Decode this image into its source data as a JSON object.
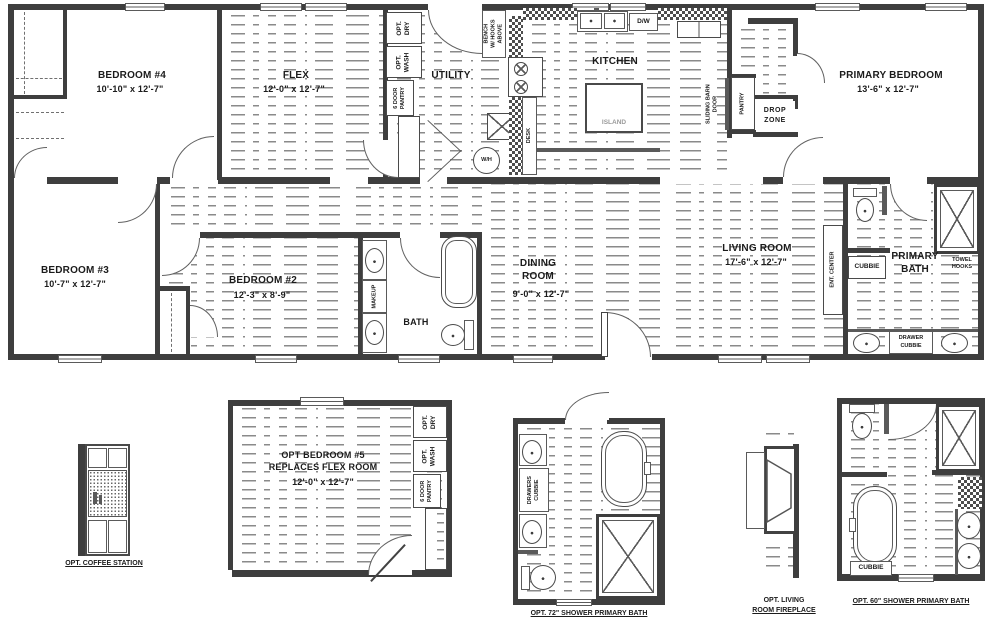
{
  "main": {
    "bedroom4": {
      "name": "BEDROOM #4",
      "dims": "10'-10\" x  12'-7\""
    },
    "flex": {
      "name": "FLEX",
      "dims": "12'-0\" x  12'-7\""
    },
    "utility": {
      "name": "UTILITY"
    },
    "kitchen": {
      "name": "KITCHEN"
    },
    "primary_bedroom": {
      "name": "PRIMARY BEDROOM",
      "dims": "13'-6\" x  12'-7\""
    },
    "bedroom3": {
      "name": "BEDROOM #3",
      "dims": "10'-7\" x  12'-7\""
    },
    "bedroom2": {
      "name": "BEDROOM #2",
      "dims": "12'-3\" x  8'-9\""
    },
    "dining": {
      "l1": "DINING",
      "l2": "ROOM",
      "dims": "9'-0\" x  12'-7\""
    },
    "living": {
      "name": "LIVING ROOM",
      "dims": "17'-6\" x  12'-7\""
    },
    "bath": {
      "name": "BATH"
    },
    "primary_bath": {
      "l1": "PRIMARY",
      "l2": "BATH"
    },
    "labels": {
      "opt_dry_l1": "OPT.",
      "opt_dry_l2": "DRY",
      "opt_wash_l1": "OPT.",
      "opt_wash_l2": "WASH",
      "pantry6_l1": "6 DOOR",
      "pantry6_l2": "PANTRY",
      "bench_l1": "BENCH",
      "bench_l2": "W/ HOOKS",
      "bench_l3": "ABOVE",
      "dw": "D/W",
      "island": "ISLAND",
      "desk": "DESK",
      "wh": "W/H",
      "sliding_l1": "SLIDING BARN",
      "sliding_l2": "DOOR",
      "pantry": "PANTRY",
      "drop_l1": "DROP",
      "drop_l2": "ZONE",
      "makeup": "MAKEUP",
      "ent_center": "ENT. CENTER",
      "cubbie": "CUBBIE",
      "towel_l1": "TOWEL",
      "towel_l2": "HOOKS",
      "drawer_l1": "DRAWER",
      "drawer_l2": "CUBBIE"
    }
  },
  "details": {
    "coffee": {
      "label": "OPT. COFFEE STATION"
    },
    "bedroom5": {
      "l1": "OPT BEDROOM #5",
      "l2": "REPLACES FLEX ROOM",
      "dims": "12'-0\" x  12'-7\"",
      "opt_dry_l1": "OPT.",
      "opt_dry_l2": "DRY",
      "opt_wash_l1": "OPT.",
      "opt_wash_l2": "WASH",
      "pantry6_l1": "6 DOOR",
      "pantry6_l2": "PANTRY"
    },
    "shower72": {
      "label": "OPT. 72\" SHOWER PRIMARY BATH",
      "drawers_l1": "DRAWERS",
      "drawers_l2": "CUBBIE"
    },
    "fireplace": {
      "l1": "OPT. LIVING",
      "l2": "ROOM FIREPLACE"
    },
    "shower60": {
      "label": "OPT. 60\" SHOWER PRIMARY BATH",
      "cubbie": "CUBBIE"
    }
  }
}
